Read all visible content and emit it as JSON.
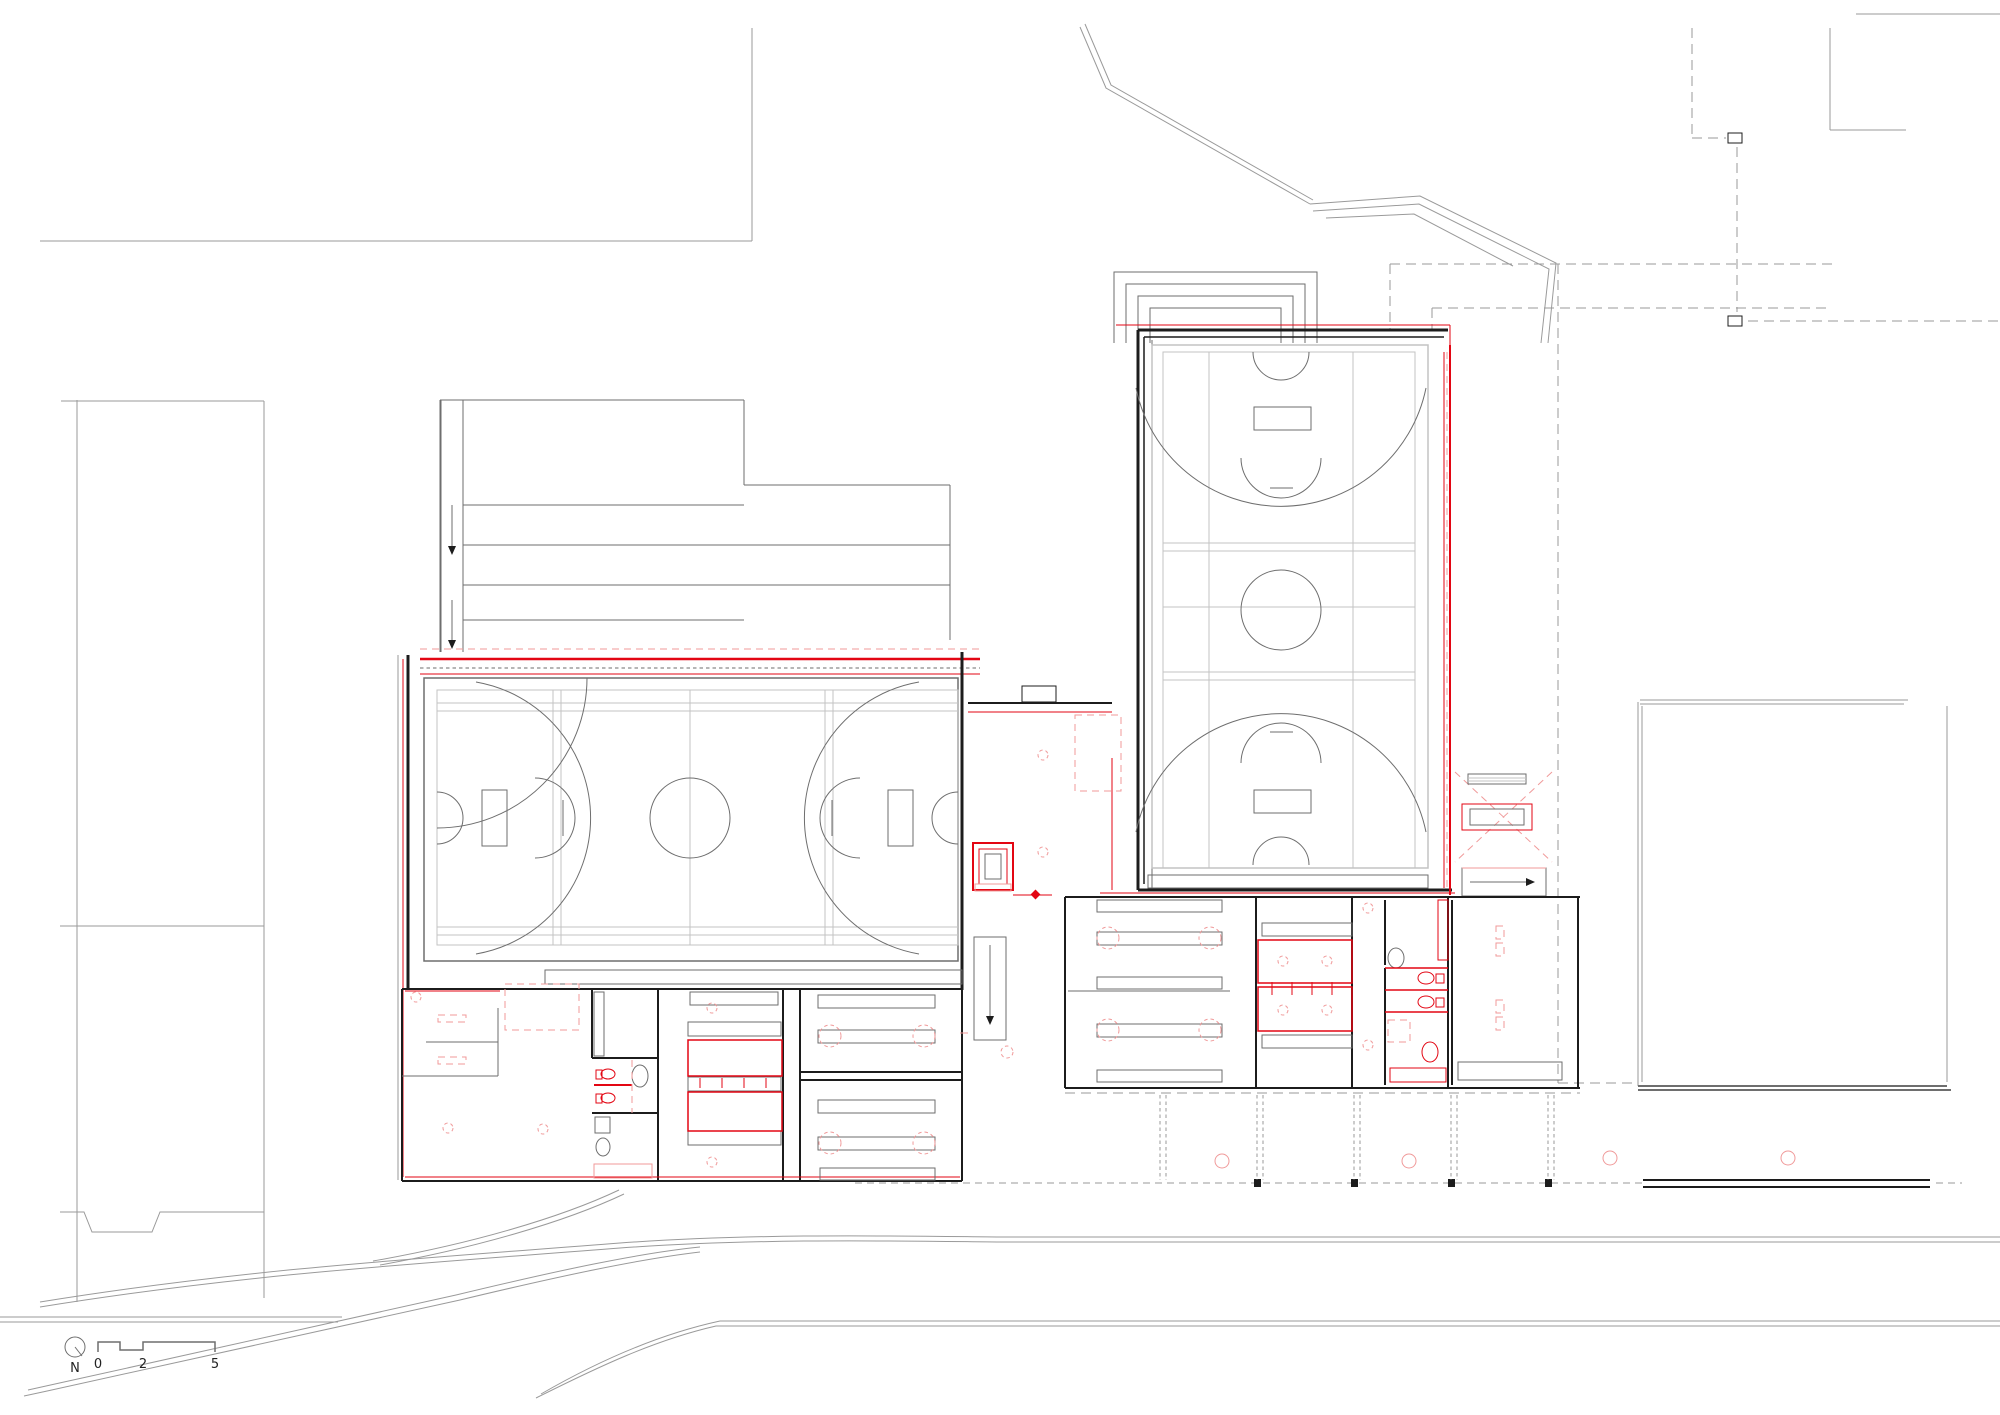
{
  "drawing": {
    "type": "architectural-floor-plan",
    "description": "Ground floor site plan of a sports complex: west sports hall with three-court basketball layout, east sports hall with full-length basketball court, locker and shower wings, connector lobby with elevator and stairs, surrounding roads and neighbouring buildings",
    "visible_text_only": [
      "N",
      "0",
      "2",
      "5"
    ]
  },
  "scale_bar": {
    "north_label": "N",
    "ticks": [
      "0",
      "2",
      "5"
    ]
  },
  "colors": {
    "background": "#ffffff",
    "wall": "#1c1c1c",
    "site_line": "#9a9a9a",
    "detail_line": "#6e6e6e",
    "court_line": "#c3c3c3",
    "red": "#e30613",
    "red_light": "#f09a9a"
  }
}
